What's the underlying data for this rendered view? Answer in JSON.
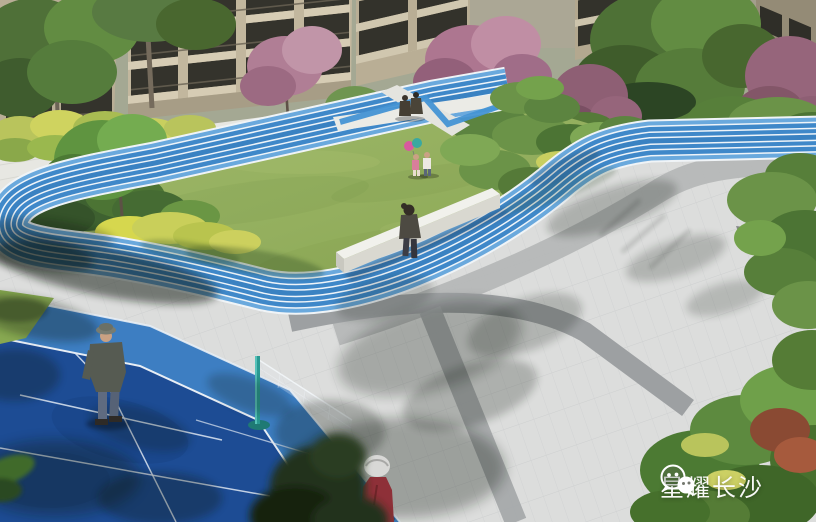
{
  "watermark": {
    "text": "星耀长沙",
    "icon": "wechat-logo-icon",
    "text_color": "#ffffff"
  },
  "scene": {
    "type": "residential-courtyard-landscape-rendering",
    "areas": {
      "running_track": "blue-jogging-track-with-white-lane-lines",
      "lawn": "central-green-lawn",
      "badminton_court": "blue-badminton-court",
      "plaza": "gray-paved-plaza",
      "buildings": "beige-apartment-buildings",
      "path_crossing": "white-path-crossing-with-blue-ribbon",
      "bench": "long-white-seat-wall"
    },
    "people": [
      "man-standing-on-court",
      "woman-sitting-on-bench",
      "child-with-pink-top",
      "child-with-white-top",
      "two-people-sitting-at-crossing",
      "elderly-woman-in-red"
    ]
  },
  "colors": {
    "track_blue": "#3f88c9",
    "track_blue_light": "#6aa9dd",
    "lane_line_white": "#eef4f9",
    "lawn_green": "#93b058",
    "court_blue": "#3d7ec2",
    "court_navy": "#1d4c94",
    "paving_light": "#dcdddc",
    "paving_medium": "#b0b2b3",
    "paving_dark": "#9b9da0",
    "net_post_teal": "#2a9a92",
    "building_beige": "#c2b79e",
    "foliage_green": "#577f3a",
    "foliage_pink": "#ad7690",
    "shrub_yellow": "#c9cf5e",
    "walkway_white": "#e7e7e2"
  }
}
